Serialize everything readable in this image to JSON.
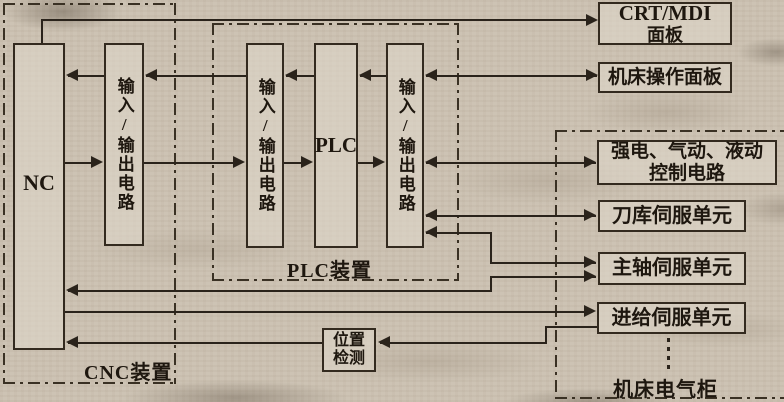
{
  "diagram": {
    "boxes": {
      "nc": {
        "label": "NC"
      },
      "io1": {
        "label": "输入/输出电路"
      },
      "io2": {
        "label": "输入/输出电路"
      },
      "plc": {
        "label": "PLC"
      },
      "io3": {
        "label": "输入/输出电路"
      },
      "crt_mdi": {
        "line1": "CRT/MDI",
        "line2": "面板"
      },
      "operation_panel": {
        "label": "机床操作面板"
      },
      "power_circuit": {
        "line1": "强电、气动、液动",
        "line2": "控制电路"
      },
      "tool_servo": {
        "label": "刀库伺服单元"
      },
      "spindle_servo": {
        "label": "主轴伺服单元"
      },
      "feed_servo": {
        "label": "进给伺服单元"
      },
      "position_detect": {
        "line1": "位置",
        "line2": "检测"
      }
    },
    "groups": {
      "cnc_unit": "CNC装置",
      "plc_unit": "PLC装置",
      "cabinet": "机床电气柜"
    },
    "colors": {
      "paper": "#cdc3b4",
      "line": "#2a231b",
      "box_border": "#332a1f"
    }
  }
}
